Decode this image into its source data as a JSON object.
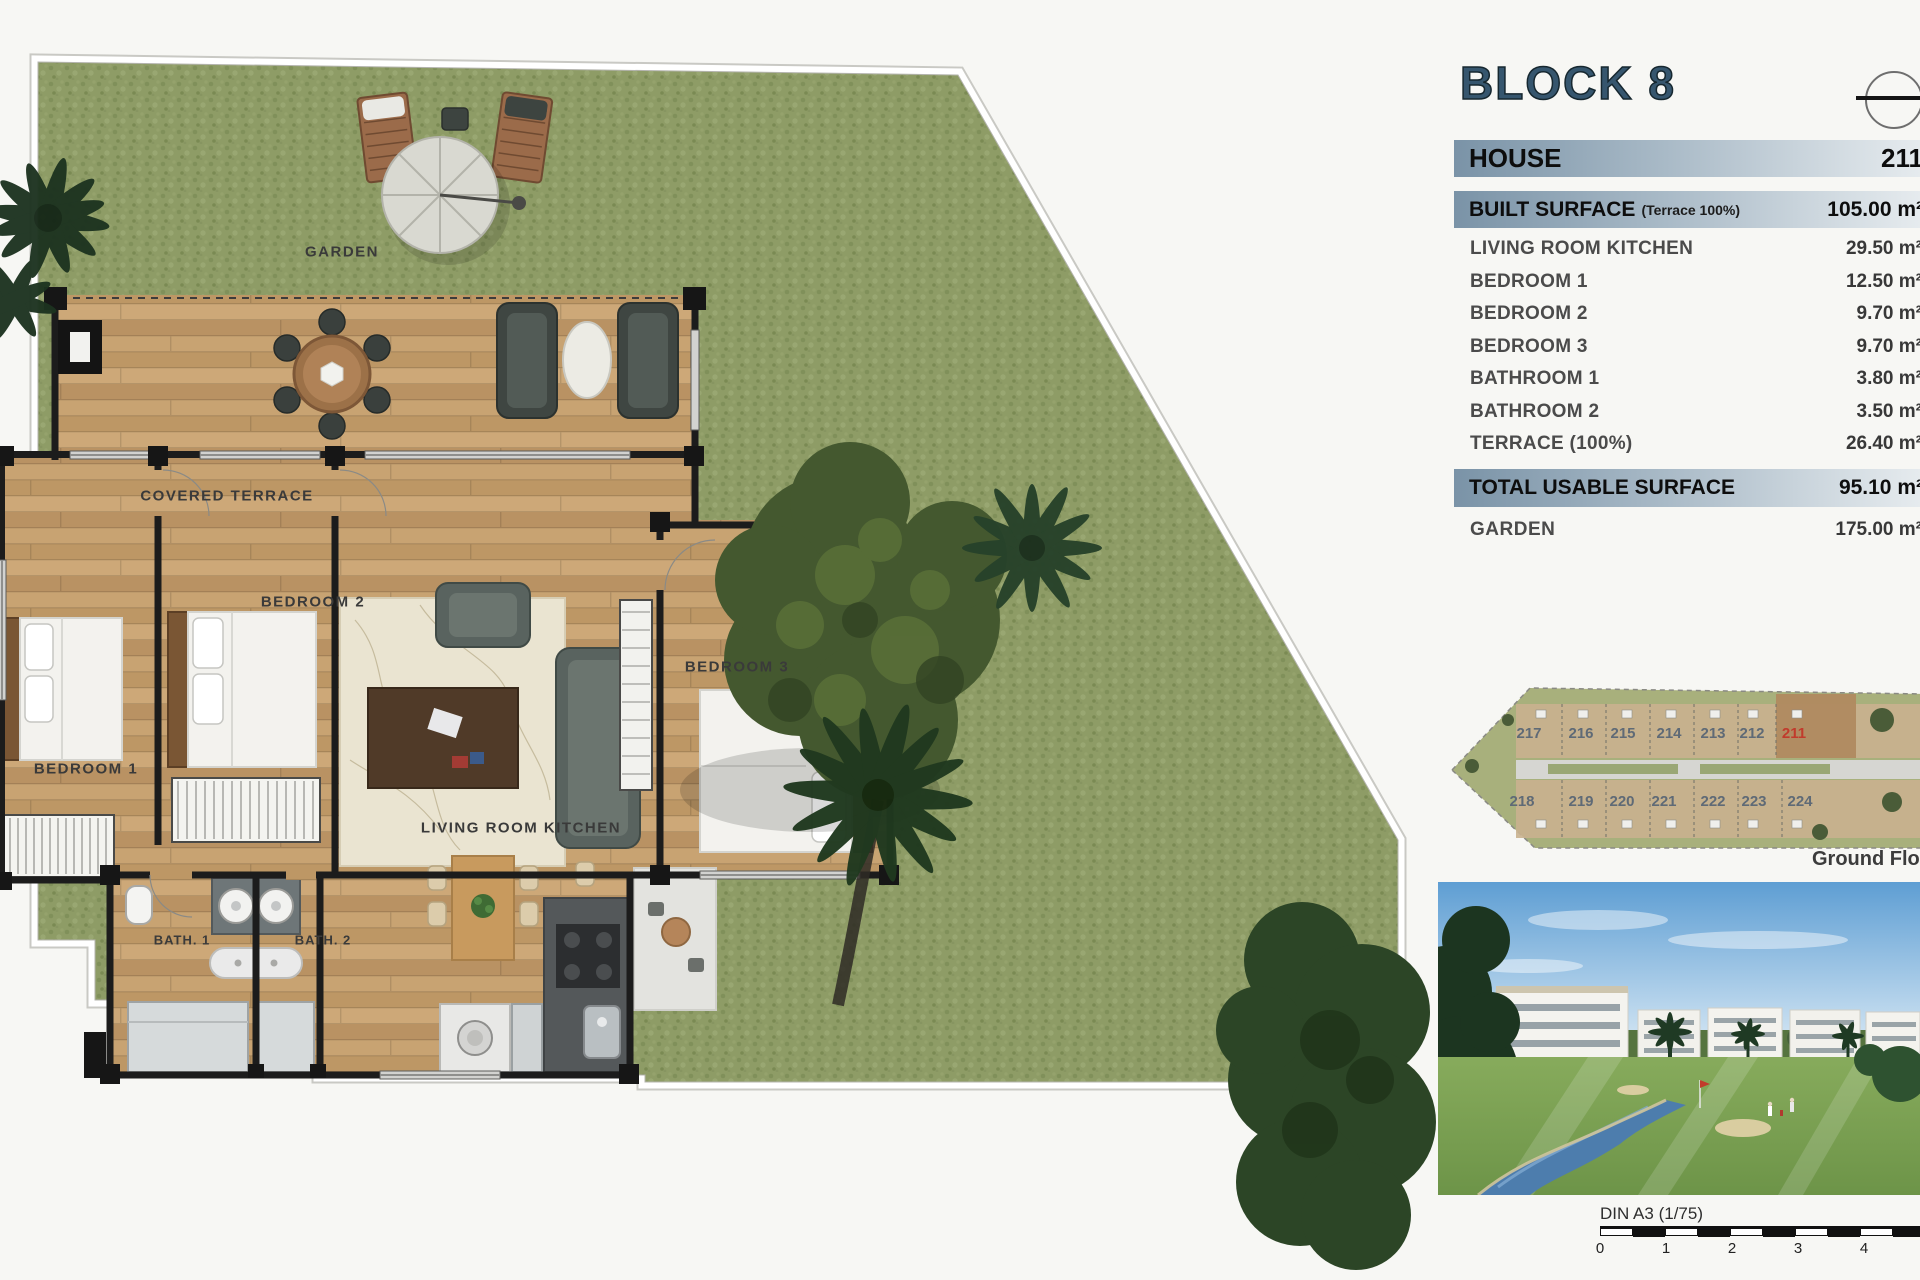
{
  "page": {
    "background": "#f7f7f4"
  },
  "title": {
    "text": "BLOCK 8",
    "color": "#36566e"
  },
  "panel": {
    "house_row": {
      "label": "HOUSE",
      "value": "211"
    },
    "built_row": {
      "label": "BUILT SURFACE",
      "note": "(Terrace 100%)",
      "value": "105.00 m²"
    },
    "rooms": [
      {
        "label": "LIVING ROOM KITCHEN",
        "value": "29.50 m²"
      },
      {
        "label": "BEDROOM 1",
        "value": "12.50 m²"
      },
      {
        "label": "BEDROOM 2",
        "value": "9.70 m²"
      },
      {
        "label": "BEDROOM 3",
        "value": "9.70 m²"
      },
      {
        "label": "BATHROOM 1",
        "value": "3.80 m²"
      },
      {
        "label": "BATHROOM 2",
        "value": "3.50 m²"
      },
      {
        "label": "TERRACE (100%)",
        "value": "26.40 m²"
      }
    ],
    "total_row": {
      "label": "TOTAL USABLE SURFACE",
      "value": "95.10 m²"
    },
    "garden_row": {
      "label": "GARDEN",
      "value": "175.00 m²"
    }
  },
  "floor_plan": {
    "labels": {
      "garden": "GARDEN",
      "covered_terrace": "COVERED TERRACE",
      "bedroom1": "BEDROOM 1",
      "bedroom2": "BEDROOM 2",
      "bedroom3": "BEDROOM 3",
      "living": "LIVING ROOM KITCHEN",
      "bath1": "BATH. 1",
      "bath2": "BATH. 2"
    }
  },
  "site_plan": {
    "caption": "Ground Floor",
    "top_units": [
      "217",
      "216",
      "215",
      "214",
      "213",
      "212",
      "211"
    ],
    "bottom_units": [
      "218",
      "219",
      "220",
      "221",
      "222",
      "223",
      "224"
    ],
    "highlight_unit": "211",
    "highlight_color": "#c13b2c"
  },
  "scale_bar": {
    "label": "DIN A3 (1/75)",
    "ticks": [
      "0",
      "1",
      "2",
      "3",
      "4"
    ]
  }
}
